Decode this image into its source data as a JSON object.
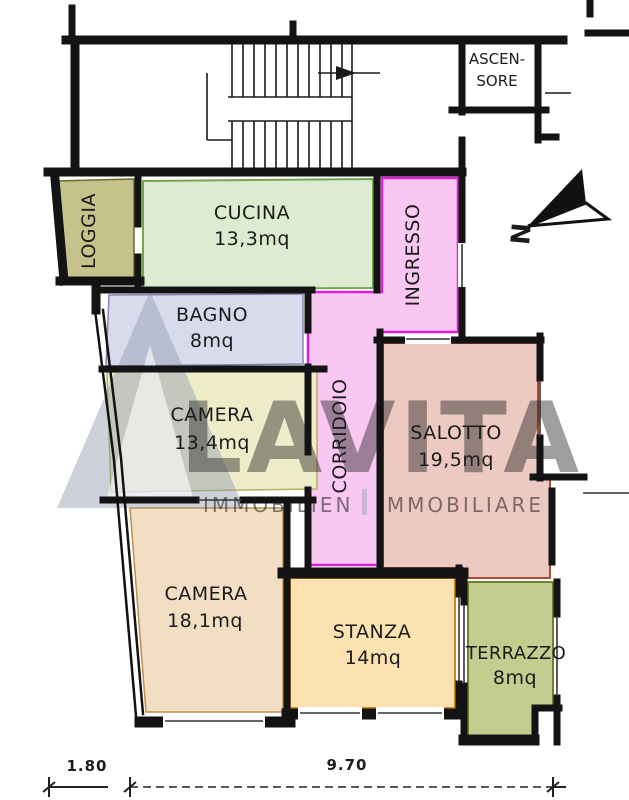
{
  "rooms": {
    "ascensore": {
      "line1": "ASCEN-",
      "line2": "SORE",
      "color": "#ffffff"
    },
    "loggia": {
      "label": "LOGGIA",
      "color": "#c6c28b"
    },
    "cucina": {
      "label": "CUCINA",
      "area": "13,3mq",
      "color": "#ddecd0"
    },
    "ingresso": {
      "label": "INGRESSO",
      "color": "#f8c8f2"
    },
    "corridoio": {
      "label": "CORRIDOIO",
      "color": "#f8c8f2"
    },
    "bagno": {
      "label": "BAGNO",
      "area": "8mq",
      "color": "#d8dbec"
    },
    "camera1": {
      "label": "CAMERA",
      "area": "13,4mq",
      "color": "#efecca"
    },
    "salotto": {
      "label": "SALOTTO",
      "area": "19,5mq",
      "color": "#ecc9c1"
    },
    "camera2": {
      "label": "CAMERA",
      "area": "18,1mq",
      "color": "#f2dfc3"
    },
    "stanza": {
      "label": "STANZA",
      "area": "14mq",
      "color": "#fce2b1"
    },
    "terrazzo": {
      "label": "TERRAZZO",
      "area": "8mq",
      "color": "#c3cd8f"
    }
  },
  "dimensions": {
    "left_width": "1.80",
    "main_width": "9.70"
  },
  "compass": {
    "north": "N"
  },
  "watermark": {
    "wordmark": "LAVITA",
    "sub_left": "IMMOBILIEN",
    "sub_right": "IMMOBILIARE",
    "color": "#9aa5b8"
  },
  "colors": {
    "wall": "#131313",
    "pink_border": "#e01fd8"
  }
}
